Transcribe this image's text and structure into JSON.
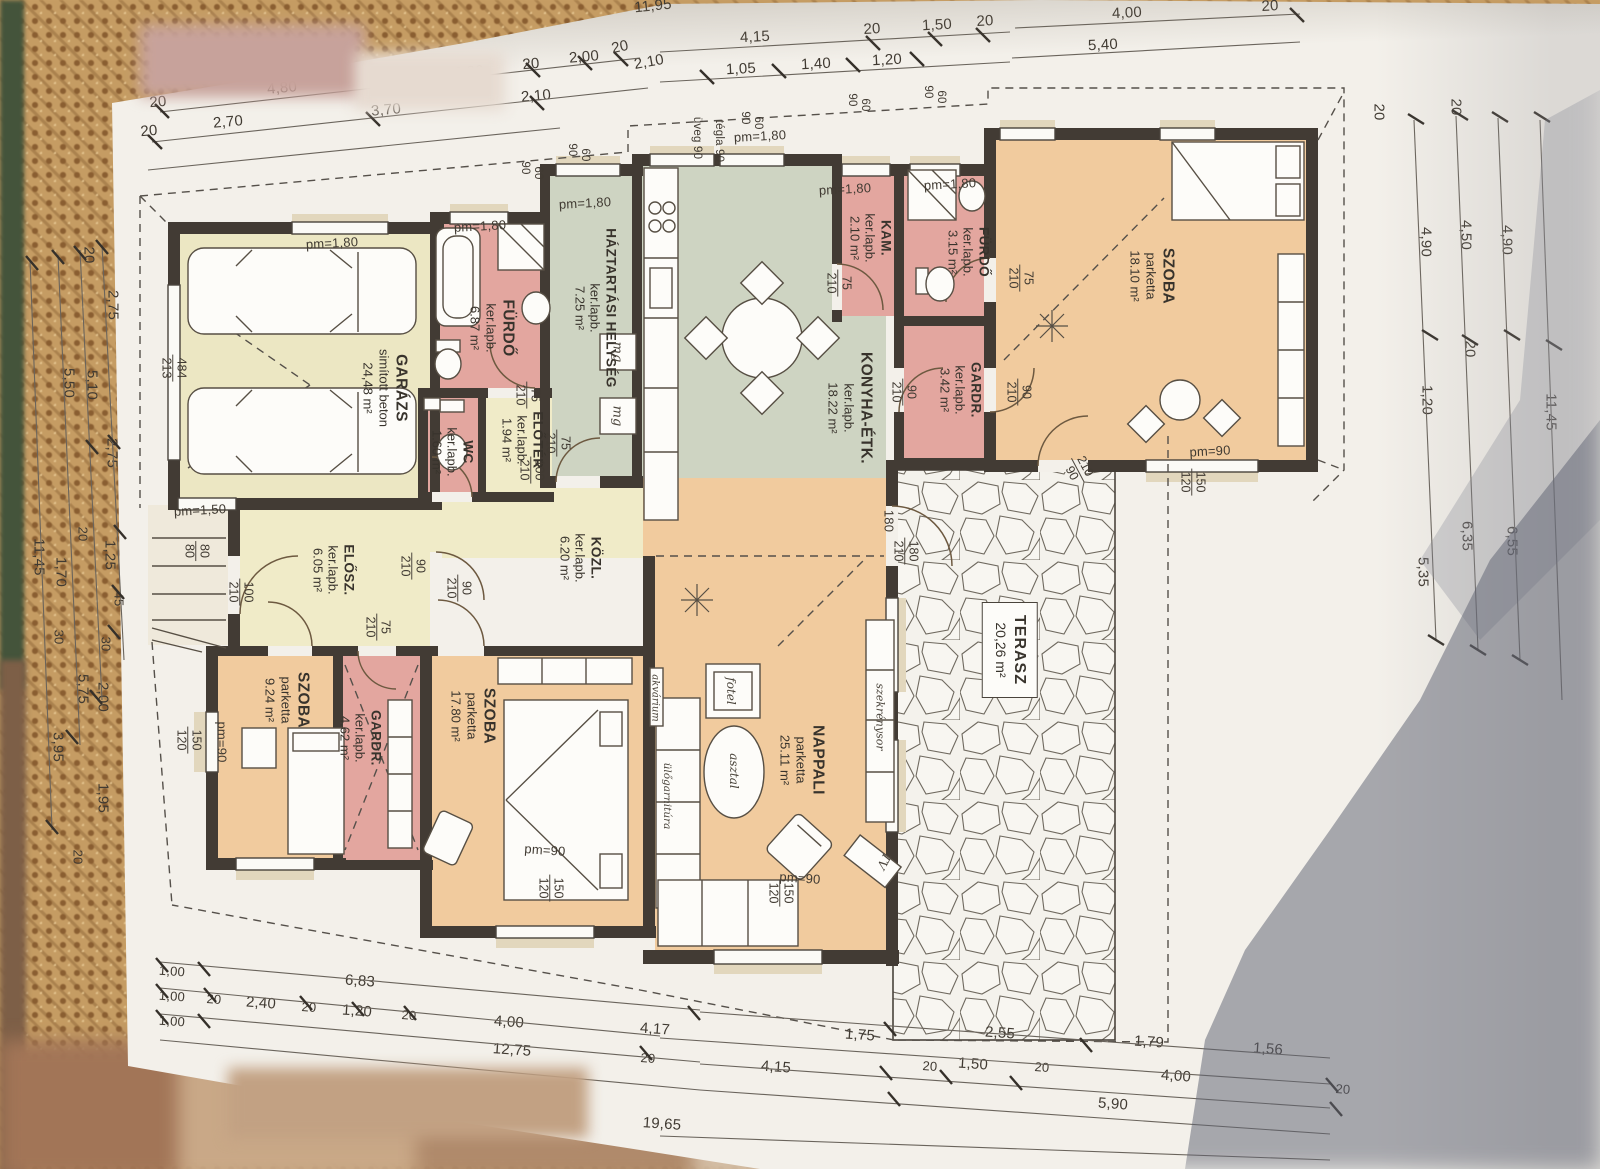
{
  "rooms": {
    "garazs": {
      "name": "GARÁZS",
      "finish": "simított beton",
      "area": "24,48 m²"
    },
    "furdo1": {
      "name": "FÜRDŐ",
      "finish": "ker.lapb.",
      "area": "6.87 m²"
    },
    "hazt": {
      "name": "HÁZTARTÁSI HELYSÉG",
      "finish": "ker.lapb.",
      "area": "7.25 m²"
    },
    "konyha": {
      "name": "KONYHA-ÉTK.",
      "finish": "ker.lapb.",
      "area": "18.22 m²"
    },
    "kam": {
      "name": "KAM.",
      "finish": "ker.lapb.",
      "area": "2.10 m²"
    },
    "furdo2": {
      "name": "FÜRDŐ",
      "finish": "ker.lapb.",
      "area": "3.15 m²"
    },
    "gardr3": {
      "name": "GARDR.",
      "finish": "ker.lapb.",
      "area": "3.42 m²"
    },
    "szoba18": {
      "name": "SZOBA",
      "finish": "parketta",
      "area": "18.10 m²"
    },
    "wc": {
      "name": "WC",
      "finish": "ker.lapb.",
      "area": "1.60 m²"
    },
    "eloter": {
      "name": "ELŐTÉR",
      "finish": "ker.lapb.",
      "area": "1.94 m²"
    },
    "kozl": {
      "name": "KÖZL.",
      "finish": "ker.lapb.",
      "area": "6.20 m²"
    },
    "elosz": {
      "name": "ELŐSZ.",
      "finish": "ker.lapb.",
      "area": "6.05 m²"
    },
    "szoba9": {
      "name": "SZOBA",
      "finish": "parketta",
      "area": "9.24 m²"
    },
    "gardr4": {
      "name": "GARDR.",
      "finish": "ker.lapb.",
      "area": "4.62 m²"
    },
    "szoba17": {
      "name": "SZOBA",
      "finish": "parketta",
      "area": "17.80 m²"
    },
    "nappali": {
      "name": "NAPPALI",
      "finish": "parketta",
      "area": "25.11 m²"
    },
    "terasz": {
      "name": "TERASZ",
      "area": "20,26 m²"
    }
  },
  "furniture": {
    "fotel": "fotel",
    "asztal": "asztal",
    "ulogarnitura": "ülőgarnitúra",
    "akvarium": "akvárium",
    "szekrenysor": "szekrénysor",
    "tv": "TV",
    "mg": "mg"
  },
  "marks": {
    "pm180": "pm=1,80",
    "pm150": "pm=1,50",
    "pm90": "pm=90",
    "uveg": "üveg 90",
    "tegla": "tégla 90"
  },
  "dims": {
    "d20": "20",
    "d30": "30",
    "d45": "45",
    "d60": "60",
    "d75": "75",
    "d80": "80",
    "d90": "90",
    "d100": "100",
    "d120": "120",
    "d150": "150",
    "d180": "180",
    "d210": "210",
    "d213": "213",
    "d484": "484",
    "d1_00": "1,00",
    "d1_05": "1,05",
    "d1_20": "1,20",
    "d1_25": "1,25",
    "d1_40": "1,40",
    "d1_50": "1,50",
    "d1_56": "1,56",
    "d1_70": "1,70",
    "d1_75": "1,75",
    "d1_79": "1,79",
    "d1_95": "1,95",
    "d2_00": "2,00",
    "d2_10": "2,10",
    "d2_30": "2,30",
    "d2_40": "2,40",
    "d2_55": "2,55",
    "d2_70": "2,70",
    "d2_75": "2,75",
    "d3_70": "3,70",
    "d3_95": "3,95",
    "d4_00": "4,00",
    "d4_15": "4,15",
    "d4_17": "4,17",
    "d4_50": "4,50",
    "d4_80": "4,80",
    "d4_90": "4,90",
    "d5_10": "5,10",
    "d5_35": "5,35",
    "d5_40": "5,40",
    "d5_50": "5,50",
    "d5_75": "5,75",
    "d5_90": "5,90",
    "d6_35": "6,35",
    "d6_55": "6,55",
    "d6_83": "6,83",
    "d11_45": "11,45",
    "d11_95": "11,95",
    "d12_75": "12,75",
    "d19_65": "19,65"
  }
}
